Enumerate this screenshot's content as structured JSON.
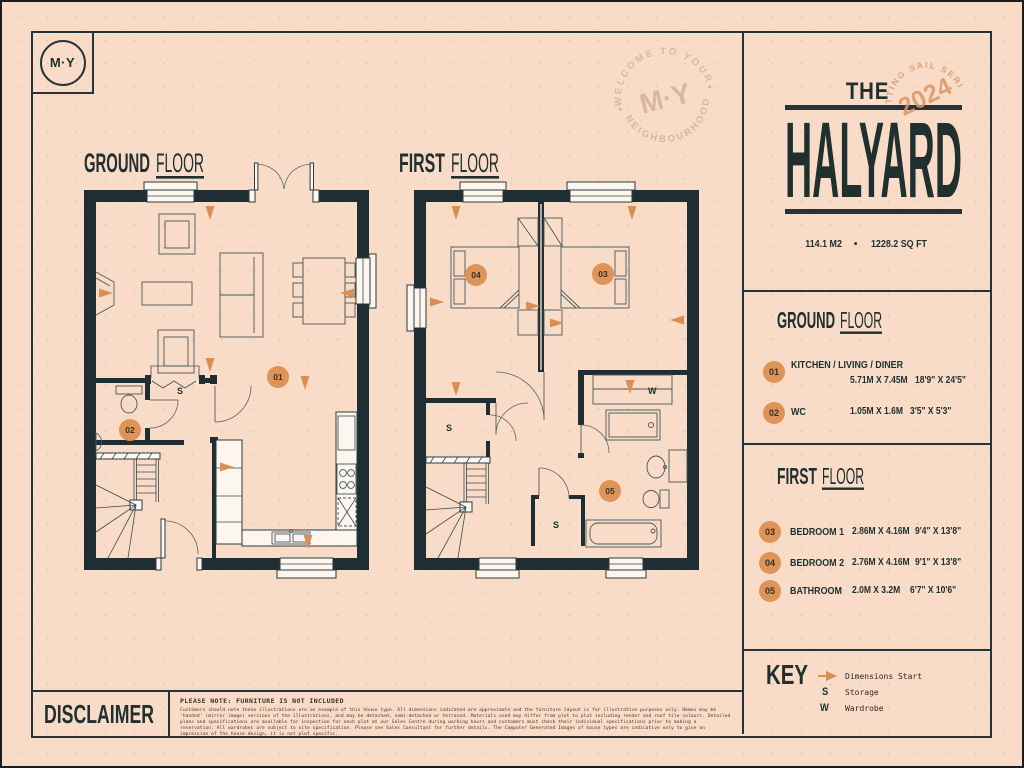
{
  "branding": {
    "logo_text": "M·Y",
    "watermark_top": "WELCOME TO YOUR",
    "watermark_bottom": "NEIGHBOURHOOD",
    "watermark_center": "M·Y"
  },
  "title_panel": {
    "pre": "THE",
    "name": "HALYARD",
    "stamp_year": "2024",
    "stamp_arc": "SETTING SAIL SERIES",
    "area_m2": "114.1 M2",
    "dot": "•",
    "area_sqft": "1228.2 SQ FT"
  },
  "ground_panel": {
    "title_a": "GROUND",
    "title_b": "FLOOR",
    "rooms": [
      {
        "num": "01",
        "name": "KITCHEN / LIVING / DINER",
        "metric": "5.71M X 7.45M",
        "imperial": "18'9\" X 24'5\""
      },
      {
        "num": "02",
        "name": "WC",
        "metric": "1.05M X 1.6M",
        "imperial": "3'5\" X 5'3\""
      }
    ]
  },
  "first_panel": {
    "title_a": "FIRST",
    "title_b": "FLOOR",
    "rooms": [
      {
        "num": "03",
        "name": "BEDROOM 1",
        "metric": "2.86M X 4.16M",
        "imperial": "9'4\" X 13'8\""
      },
      {
        "num": "04",
        "name": "BEDROOM 2",
        "metric": "2.76M X 4.16M",
        "imperial": "9'1\" X 13'8\""
      },
      {
        "num": "05",
        "name": "BATHROOM",
        "metric": "2.0M X 3.2M",
        "imperial": "6'7\" X 10'6\""
      }
    ]
  },
  "key_panel": {
    "title": "KEY",
    "items": [
      {
        "symbol": "arrow",
        "label": "Dimensions Start"
      },
      {
        "symbol": "S",
        "label": "Storage"
      },
      {
        "symbol": "W",
        "label": "Wardrobe"
      }
    ]
  },
  "disclaimer": {
    "title": "DISCLAIMER",
    "note": "PLEASE NOTE: FURNITURE IS NOT INCLUDED",
    "body": "Customers should note these illustrations are an example of this house type. All dimensions indicated are approximate and the furniture layout is for illustrative purposes only. Homes may be 'handed' (mirror image) versions of the illustrations, and may be detached, semi-detached or terraced. Materials used may differ from plot to plot including render and roof tile colours. Detailed plans and specifications are available for inspection for each plot at our Sales Centre during working hours and customers must check their individual specifications prior to making a reservation. All wardrobes are subject to site specification. Please see Sales Consultant for further details. The Computer Generated Images of house types are indicative only to give an impression of the house design, it is not plot specific."
  },
  "plans": {
    "ground": {
      "title_a": "GROUND",
      "title_b": "FLOOR",
      "m01": "01",
      "m02": "02",
      "s": "S"
    },
    "first": {
      "title_a": "FIRST",
      "title_b": "FLOOR",
      "m03": "03",
      "m04": "04",
      "m05": "05",
      "s1": "S",
      "s2": "S",
      "w": "W"
    }
  },
  "colors": {
    "background": "#f8dcc8",
    "ink": "#20302f",
    "wall": "#1e2e33",
    "orange": "#df9356",
    "paper": "#fdf6ee"
  }
}
